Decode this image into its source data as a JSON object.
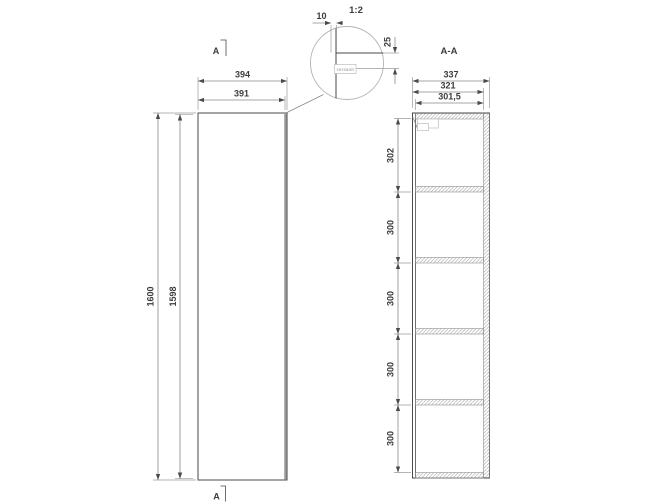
{
  "front_view": {
    "dim_width_outer": "394",
    "dim_width_inner": "391",
    "dim_height_outer": "1600",
    "dim_height_inner": "1598",
    "section_marker_top": "A",
    "section_marker_bottom": "A"
  },
  "detail_view": {
    "scale_label": "1:2",
    "dim_top_offset": "10",
    "dim_side_depth": "25",
    "brand_label": "cersanit"
  },
  "section_view": {
    "title": "A-A",
    "dim_depth_outer": "337",
    "dim_depth_carcass": "321",
    "dim_depth_interior": "301,5",
    "compartment_heights": [
      "302",
      "300",
      "300",
      "300",
      "300"
    ]
  }
}
